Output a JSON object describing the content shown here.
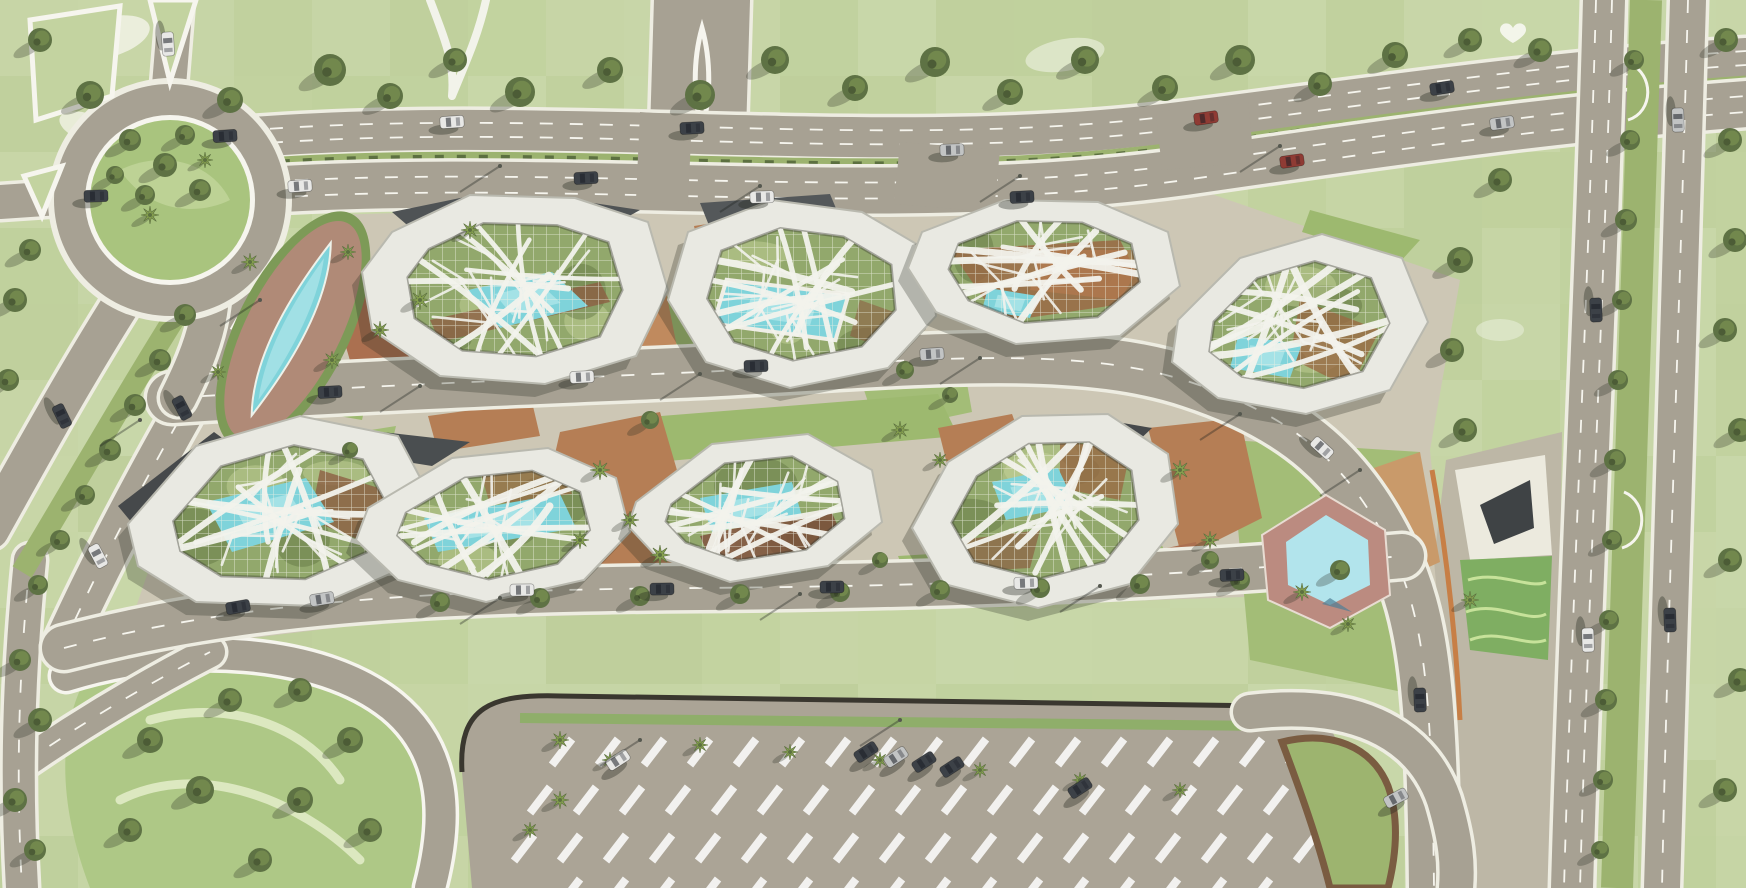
{
  "scene": {
    "type": "aerial-masterplan-rendering",
    "description": "Top-down architectural rendering of a campus masterplan: two rows of polygonal pavilion buildings with white organic branching roof structures over gridded glass courtyards, set in parkland with roads, a roundabout, two turquoise ponds, courtyard pools, street trees, palms and a large parking lot to the south.",
    "view": "plan / bird's eye",
    "text_visible": "none"
  },
  "colors": {
    "grass_base": "#c3d3a0",
    "grass_light": "#dde8c2",
    "grass_dark": "#97b271",
    "park_green": "#aec886",
    "island_green": "#a9c47e",
    "road": "#a7a193",
    "casing": "#eeede2",
    "white_line": "#f6f5ee",
    "campus_paving": "#cdc7b5",
    "plaza_paving": "#bdb7a6",
    "lot_paving": "#aba496",
    "curb_dark": "#3a372f",
    "building_ring": "#e9e9e2",
    "ring_edge": "#b9b9af",
    "courtyard_green": "#92a86c",
    "glass_grid_line": "#edf0e2",
    "pool_water": "#7fd3da",
    "pool_light": "#aae4e7",
    "pond_bed": "#b08a77",
    "pond_fringe": "#7d9a57",
    "se_pond_water": "#b2e4ec",
    "se_pond_deck": "#bb8b80",
    "terracotta": "#b57e55",
    "terracotta_dark": "#96613f",
    "slate_roof": "#46494b",
    "tree_dark": "#55663d",
    "tree_mid": "#6d8148",
    "palm_green": "#86a04f",
    "median_green": "#9cb36f",
    "car_dark": "#3c4147",
    "car_white": "#e8e8e6",
    "car_silver": "#c2c4c4",
    "car_red": "#8f3b34",
    "shadow": "rgba(40,44,34,0.28)"
  },
  "site": {
    "buildings": [
      {
        "id": "pavilion-1",
        "row": "north",
        "features": [
          "white-branch-roof",
          "glass-grid-courtyard",
          "courtyard-pool",
          "slate-entry-canopy"
        ]
      },
      {
        "id": "pavilion-2",
        "row": "north",
        "features": [
          "white-branch-roof",
          "glass-grid-courtyard",
          "large-courtyard-pool"
        ]
      },
      {
        "id": "pavilion-3",
        "row": "north",
        "features": [
          "white-branch-roof",
          "glass-grid-courtyard",
          "terracotta-courtyard"
        ]
      },
      {
        "id": "pavilion-4",
        "row": "north",
        "features": [
          "white-branch-roof",
          "glass-grid-courtyard",
          "courtyard-pool"
        ],
        "rotated": true
      },
      {
        "id": "pavilion-5",
        "row": "south",
        "features": [
          "white-branch-roof",
          "glass-grid-courtyard",
          "courtyard-pool",
          "slate-entry-canopy"
        ]
      },
      {
        "id": "pavilion-6",
        "row": "south",
        "features": [
          "white-branch-roof",
          "glass-grid-courtyard",
          "courtyard-pool"
        ]
      },
      {
        "id": "pavilion-7",
        "row": "south",
        "features": [
          "white-branch-roof",
          "glass-grid-courtyard",
          "courtyard-pool"
        ]
      },
      {
        "id": "pavilion-8",
        "row": "south",
        "features": [
          "white-branch-roof",
          "glass-grid-courtyard",
          "courtyard-pool"
        ],
        "rotated": true
      },
      {
        "id": "east-glass-pavilion",
        "row": "east",
        "features": [
          "sloped-green-glass-roof",
          "white-plaza",
          "dark-sculptural-canopy"
        ]
      }
    ],
    "water_features": [
      {
        "id": "northwest-pond",
        "shape": "leaf",
        "setting": "red-earth planting bed with shrub fringe and palms"
      },
      {
        "id": "southeast-pond",
        "shape": "hexagonal",
        "setting": "pink brick deck with palm"
      },
      {
        "id": "courtyard-pools",
        "count": 7
      }
    ],
    "roads": [
      "north-boulevard-upper-carriageway",
      "north-boulevard-lower-carriageway with planted median",
      "central-curved-avenue through campus",
      "south-street",
      "east-divided-highway (two carriageways, treed median, u-turn slips)",
      "west-diagonal-pair with treed median",
      "northwest-roundabout with planted island",
      "north-entry-spur with white loop marking",
      "parking-access-loop",
      "park-loop-road",
      "park-diagonal-road"
    ],
    "parking": {
      "location": "south",
      "marked_stall_rows": 4,
      "palms": true,
      "parked_vehicles_approx": 7
    },
    "vegetation": [
      "patchwork lawns",
      "street trees",
      "palm trees",
      "shrub medians",
      "golf-style sand patches"
    ],
    "vehicles_visible_approx": 35
  }
}
